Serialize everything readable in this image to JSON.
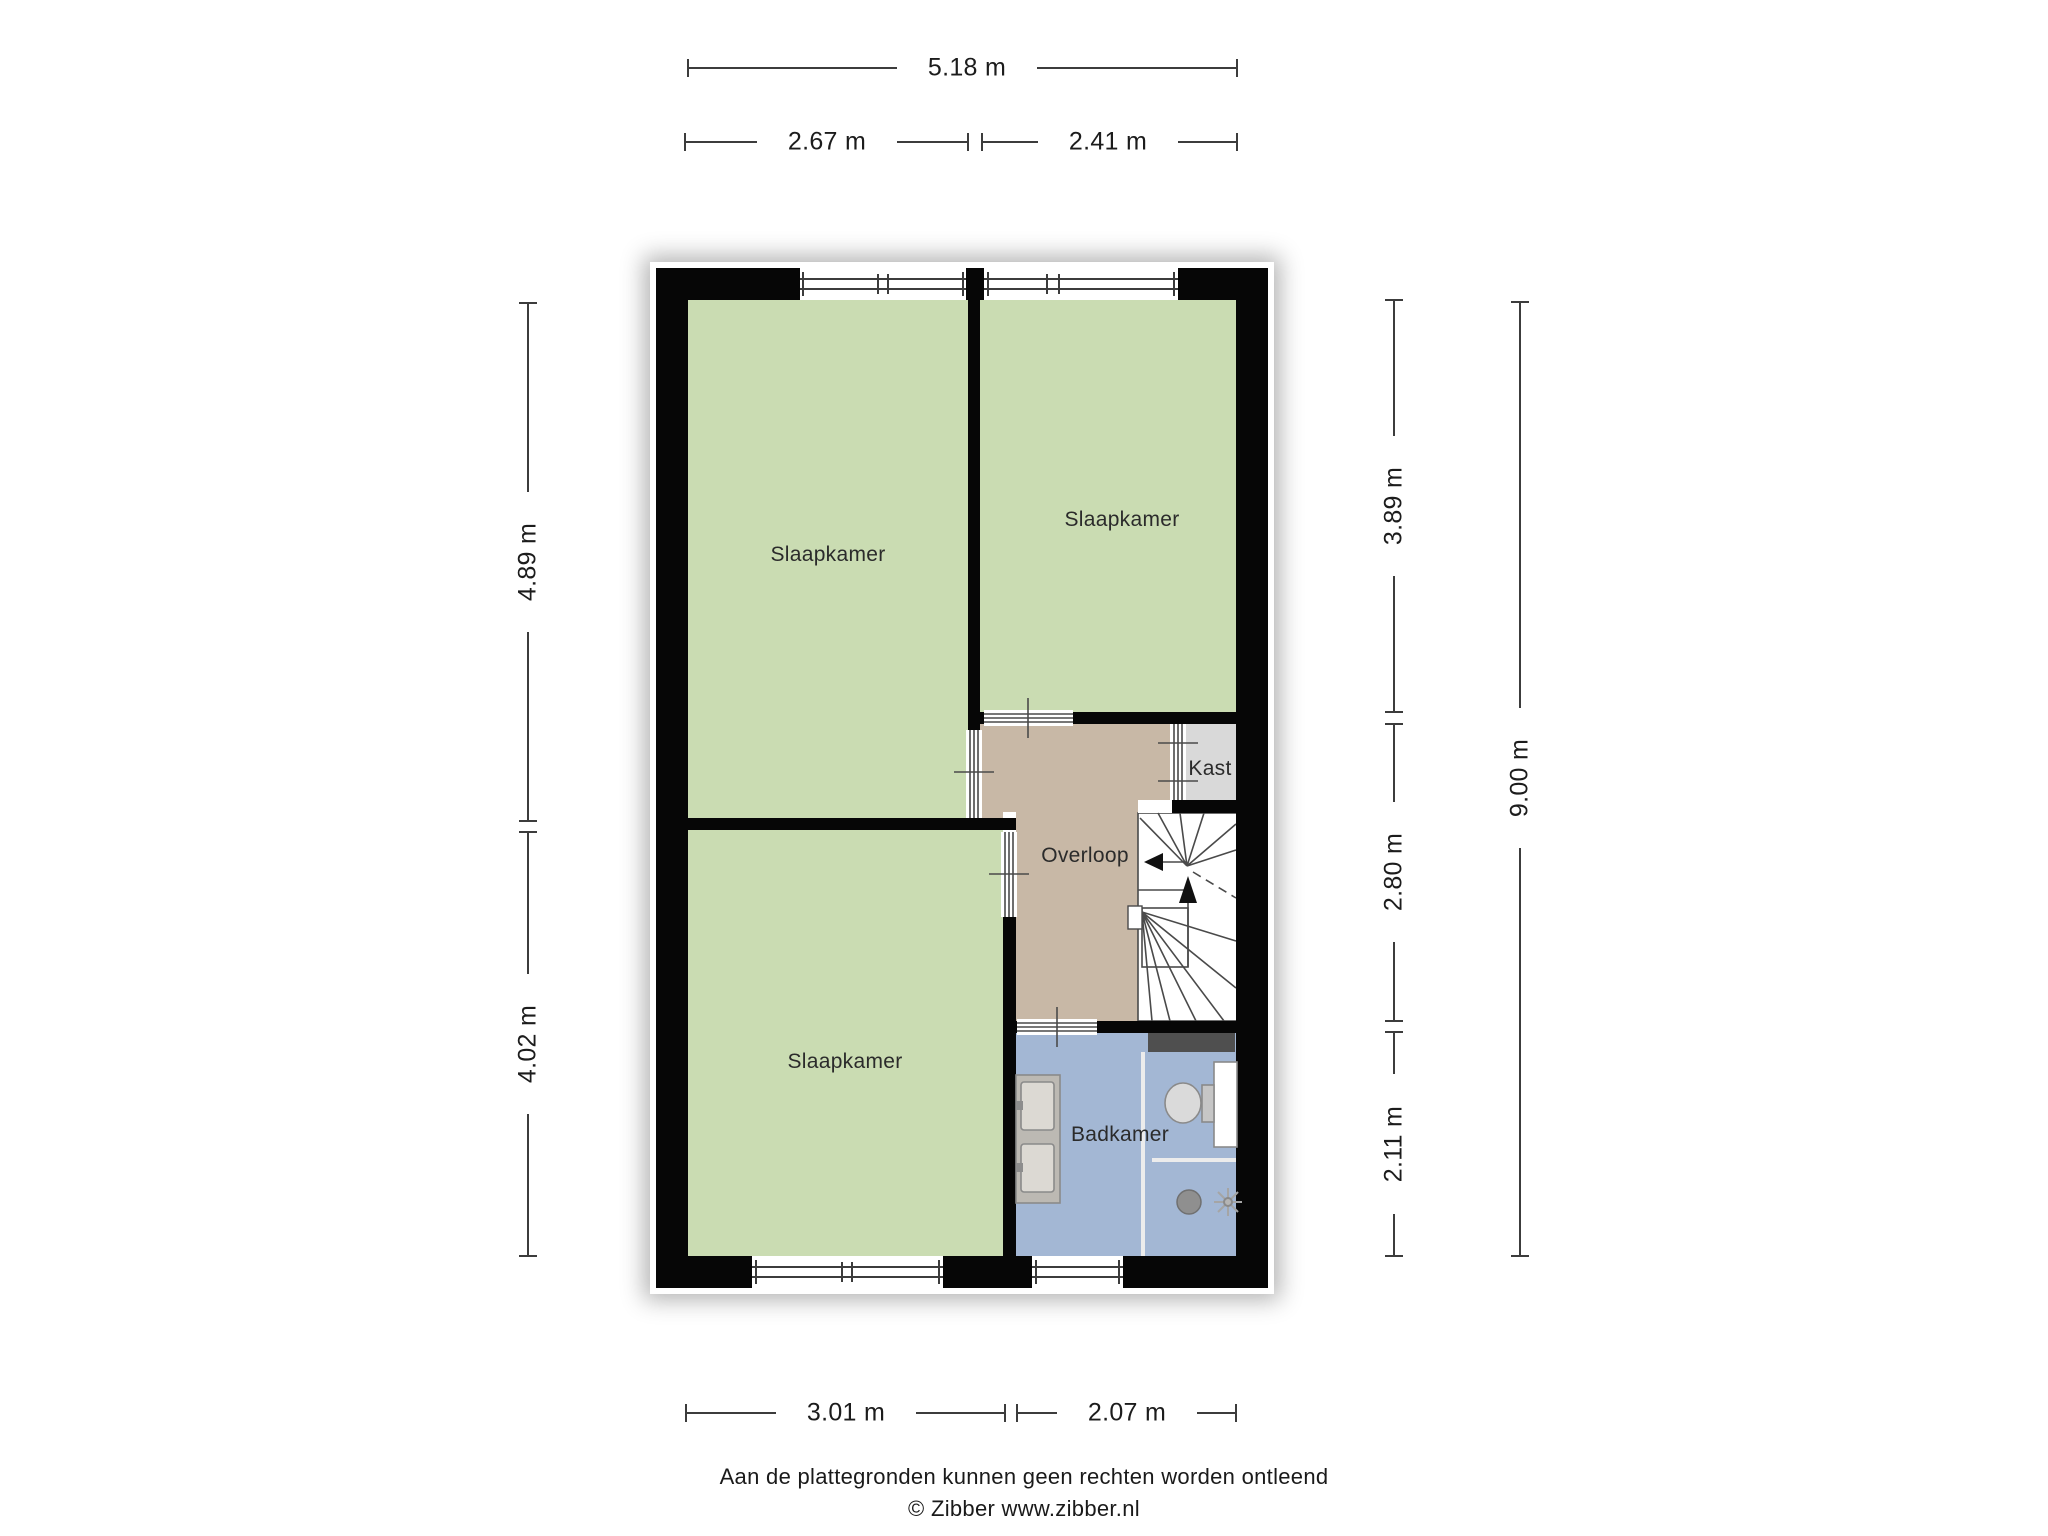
{
  "title": "Plattegrond verdieping",
  "colors": {
    "room_green": "#cadcb2",
    "hall_tan": "#c8b8a6",
    "bath_blue": "#a3b7d4",
    "closet_gray": "#d9d9d9",
    "wall_black": "#060606",
    "line_gray": "#3c3c3c"
  },
  "rooms": {
    "bedroom_top_left": {
      "label": "Slaapkamer"
    },
    "bedroom_top_right": {
      "label": "Slaapkamer"
    },
    "bedroom_bottom": {
      "label": "Slaapkamer"
    },
    "landing": {
      "label": "Overloop"
    },
    "closet": {
      "label": "Kast"
    },
    "bathroom": {
      "label": "Badkamer"
    }
  },
  "dimensions": {
    "width_total": "5.18 m",
    "width_top_left": "2.67 m",
    "width_top_right": "2.41 m",
    "height_left_upper": "4.89 m",
    "height_left_lower": "4.02 m",
    "height_right_upper": "3.89 m",
    "height_right_middle": "2.80 m",
    "height_right_lower": "2.11 m",
    "height_total": "9.00 m",
    "width_bottom_left": "3.01 m",
    "width_bottom_right": "2.07 m"
  },
  "footer": {
    "disclaimer": "Aan de plattegronden kunnen geen rechten worden ontleend",
    "copyright": "© Zibber www.zibber.nl"
  }
}
